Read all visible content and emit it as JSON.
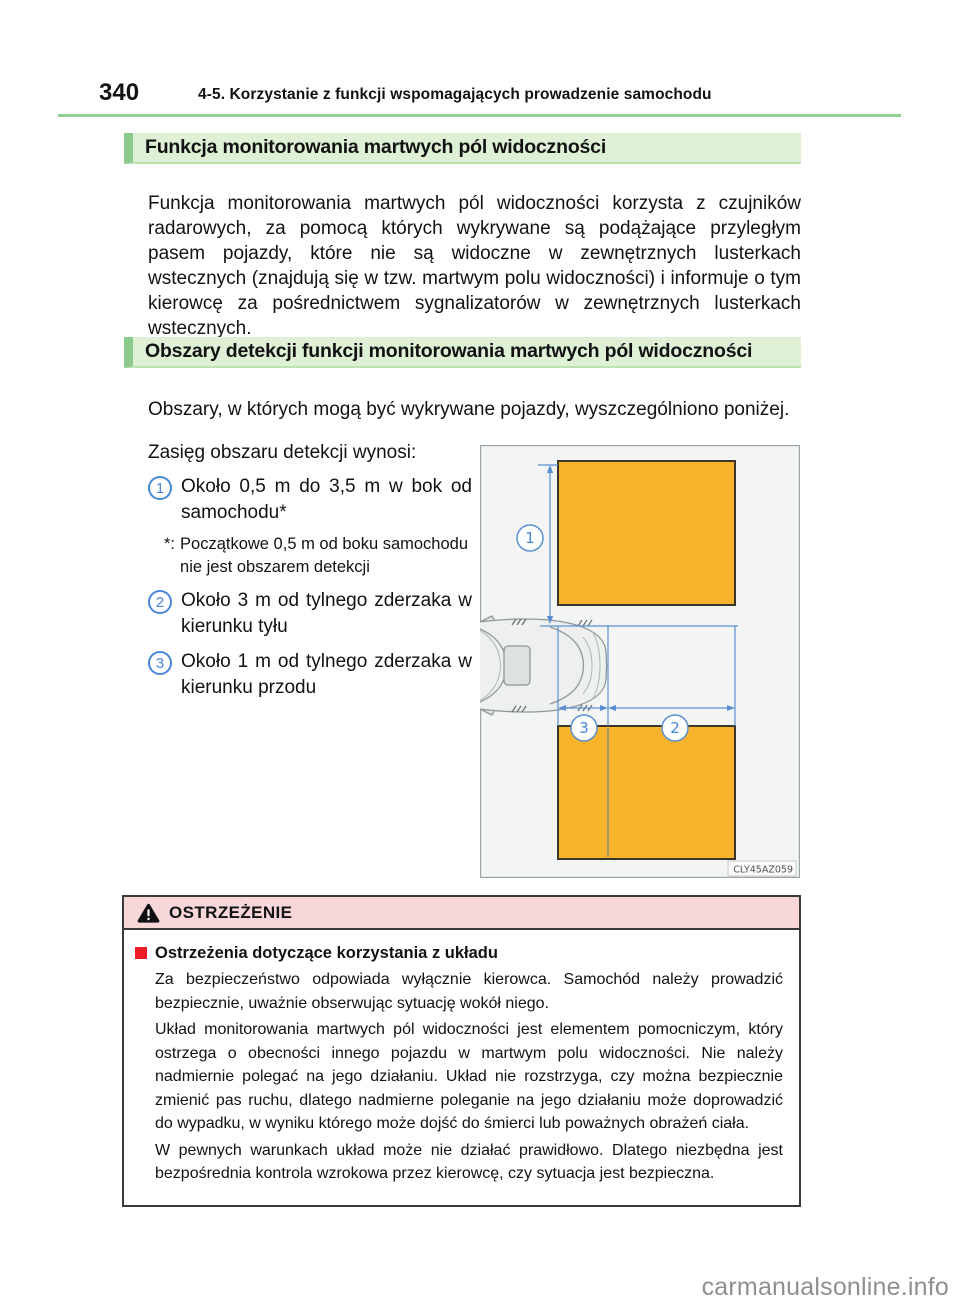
{
  "page": {
    "number": "340",
    "chapter_header": "4-5. Korzystanie z funkcji wspomagających prowadzenie samochodu",
    "watermark": "carmanualsonline.info"
  },
  "colors": {
    "heading_background": "#def0d6",
    "heading_bar": "#8cc98c",
    "header_rule": "#90d190",
    "warning_header_background": "#f7d7d7",
    "warning_bullet_red": "#ef1d25",
    "detection_zone_orange": "#f6b32b",
    "dimension_blue": "#5c8fd2",
    "circled_number_blue": "#4a86d8"
  },
  "section_blind_spot": {
    "title": "Funkcja monitorowania martwych pól widoczności",
    "body": "Funkcja monitorowania martwych pól widoczności korzysta z czujników radarowych, za pomocą których wykrywane są podążające przyległym pasem pojazdy, które nie są widoczne w zewnętrznych lusterkach wstecznych (znajdują się w tzw. martwym polu widoczności) i informuje o tym kierowcę za pośrednictwem sygnalizatorów w zewnętrznych lusterkach wstecznych."
  },
  "section_detection_areas": {
    "title": "Obszary detekcji funkcji monitorowania martwych pól widoczności",
    "intro": "Obszary, w których mogą być wykrywane pojazdy, wyszczególniono poniżej.",
    "range_intro": "Zasięg obszaru detekcji wynosi:",
    "items": [
      {
        "num": "1",
        "text": "Około 0,5 m do 3,5 m w bok od samochodu*"
      },
      {
        "num": "2",
        "text": "Około 3 m od tylnego zderzaka w kierunku tyłu"
      },
      {
        "num": "3",
        "text": "Około 1 m od tylnego zderzaka w kierunku przodu"
      }
    ],
    "footnote_marker": "*:",
    "footnote_text": "Początkowe 0,5 m od boku samochodu nie jest obszarem detekcji"
  },
  "diagram": {
    "zone_labels": [
      "1",
      "2",
      "3"
    ],
    "figure_code": "CLY45AZ059"
  },
  "warning": {
    "header": "OSTRZEŻENIE",
    "subtitle": "Ostrzeżenia dotyczące korzystania z układu",
    "paragraphs": [
      "Za bezpieczeństwo odpowiada wyłącznie kierowca. Samochód należy prowadzić bezpiecznie, uważnie obserwując sytuację wokół niego.",
      "Układ monitorowania martwych pól widoczności jest elementem pomocniczym, który ostrzega o obecności innego pojazdu w martwym polu widoczności. Nie należy nadmiernie polegać na jego działaniu. Układ nie rozstrzyga, czy można bezpiecznie zmienić pas ruchu, dlatego nadmierne poleganie na jego działaniu może doprowadzić do wypadku, w wyniku którego może dojść do śmierci lub poważnych obrażeń ciała.",
      "W pewnych warunkach układ może nie działać prawidłowo. Dlatego niezbędna jest bezpośrednia kontrola wzrokowa przez kierowcę, czy sytuacja jest bezpieczna."
    ]
  }
}
